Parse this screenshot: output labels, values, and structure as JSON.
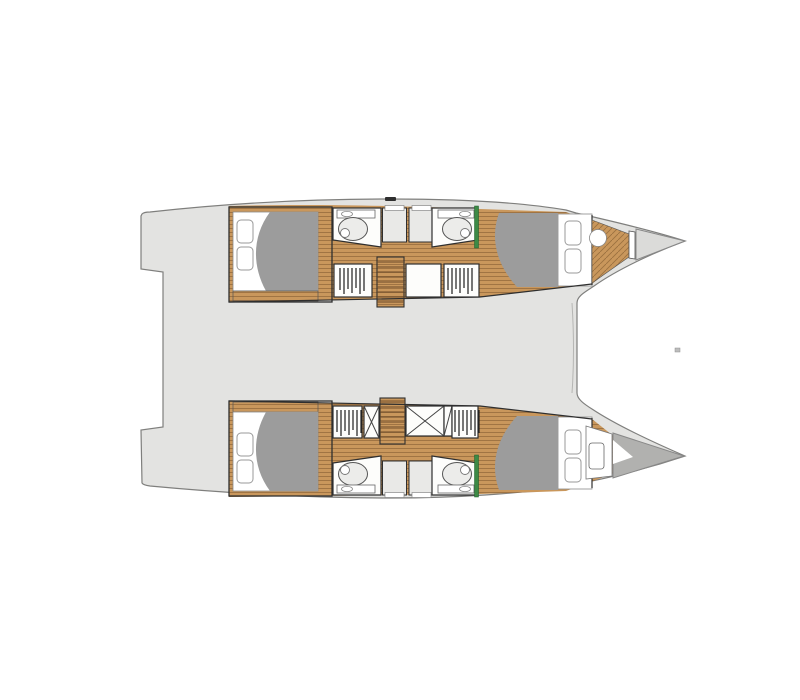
{
  "page": {
    "background": "#ffffff",
    "description": "Overhead deck plan of a four-cabin sailing catamaran: two parallel hulls with cabins, bathrooms, wardrobes and stairs, joined by an undetailed bridgedeck saloon."
  },
  "colors": {
    "deck": "#e3e3e1",
    "deck_outline": "#7f7f7d",
    "wood": "#c9975c",
    "wood_line": "#9b7040",
    "duvet": "#9c9c9c",
    "door_accent": "#3d8a46",
    "bow_light": "#dbdbd9",
    "bow_dark": "#b1b1af",
    "hatch_mark": "#2f2f2f",
    "speck": "#bdbdbd"
  },
  "plan": {
    "view": "top-down floor plan",
    "vessel": "catamaran",
    "cabin_count": 4,
    "bathroom_count": 4,
    "hulls": [
      {
        "id": "upper-hull",
        "rooms": [
          "aft-cabin",
          "aft-bathroom",
          "shower-stalls",
          "hanging-lockers",
          "staircase",
          "storage-locker",
          "forward-bathroom",
          "forward-cabin",
          "forepeak-head",
          "bow"
        ]
      },
      {
        "id": "lower-hull",
        "rooms": [
          "aft-cabin",
          "aft-bathroom",
          "shower-stalls",
          "hanging-lockers",
          "storage-lockers",
          "staircase",
          "forward-bathroom",
          "forward-cabin",
          "forepeak-berth",
          "bow"
        ]
      }
    ],
    "bridgedeck": "saloon deck (no interior detail drawn)"
  }
}
